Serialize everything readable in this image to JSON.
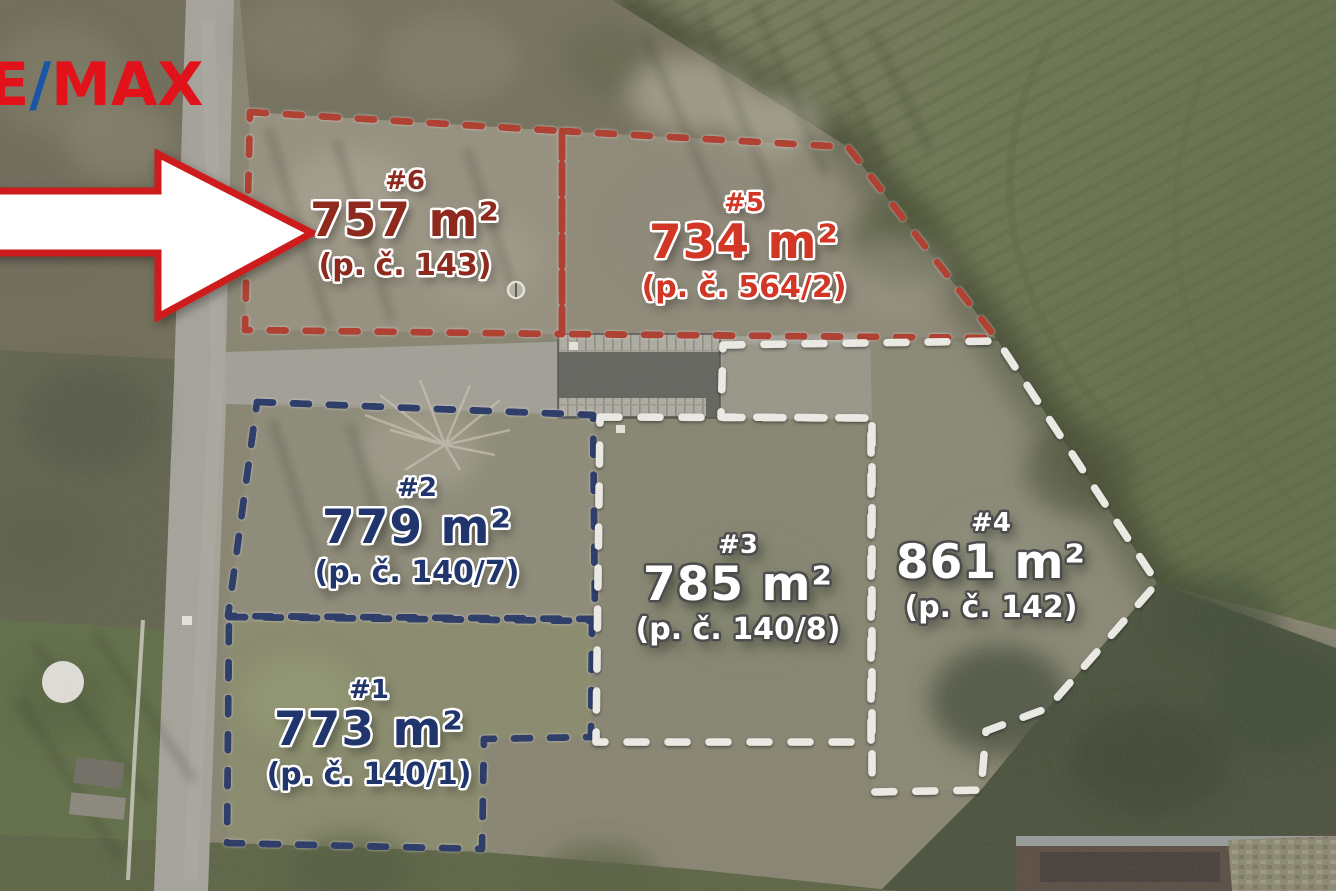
{
  "image": {
    "width": 1336,
    "height": 891,
    "description": "Aerial drone photo of six building plots for sale, annotated with dashed parcel boundaries, plot numbers, areas and parcel numbers, RE/MAX logo and a white arrow pointing to plot #6"
  },
  "logo": {
    "part_red_1": "RE",
    "part_blue": "/",
    "part_red_2": "MAX",
    "red": "#e2121b",
    "blue": "#1b55a6"
  },
  "arrow": {
    "direction": "right",
    "fill": "#ffffff",
    "border": "#ce1d1d"
  },
  "boundary_colors": {
    "red": "#b23120",
    "navy": "#1c2e62",
    "white": "#f7f6f1"
  },
  "plots": [
    {
      "number": "#1",
      "area": "773 m²",
      "area_value": 773,
      "area_unit": "m²",
      "parcel": "(p. č. 140/1)",
      "text_color": "#21356d",
      "boundary": "navy"
    },
    {
      "number": "#2",
      "area": "779 m²",
      "area_value": 779,
      "area_unit": "m²",
      "parcel": "(p. č. 140/7)",
      "text_color": "#21356d",
      "boundary": "navy"
    },
    {
      "number": "#3",
      "area": "785 m²",
      "area_value": 785,
      "area_unit": "m²",
      "parcel": "(p. č. 140/8)",
      "text_color": "#ffffff",
      "boundary": "white"
    },
    {
      "number": "#4",
      "area": "861 m²",
      "area_value": 861,
      "area_unit": "m²",
      "parcel": "(p. č. 142)",
      "text_color": "#ffffff",
      "boundary": "white"
    },
    {
      "number": "#5",
      "area": "734 m²",
      "area_value": 734,
      "area_unit": "m²",
      "parcel": "(p. č. 564/2)",
      "text_color": "#d23726",
      "boundary": "red"
    },
    {
      "number": "#6",
      "area": "757 m²",
      "area_value": 757,
      "area_unit": "m²",
      "parcel": "(p. č. 143)",
      "text_color": "#8d2a1d",
      "boundary": "red"
    }
  ]
}
